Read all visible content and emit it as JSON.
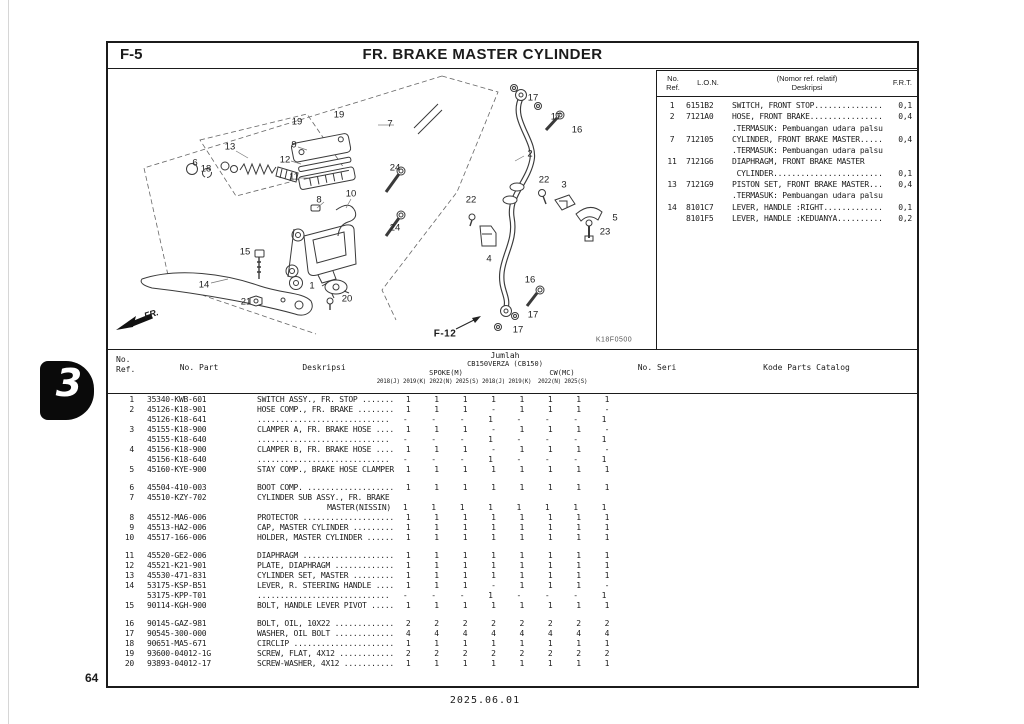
{
  "page": {
    "fig_code": "F-5",
    "title": "FR. BRAKE MASTER CYLINDER",
    "section_tab": "3",
    "page_number": "64",
    "footer_date": "2025.06.01"
  },
  "diagram": {
    "code": "K18F0500",
    "link_label": "F-12",
    "fr_label": "FR.",
    "callouts": [
      {
        "n": "19",
        "x": 189,
        "y": 54
      },
      {
        "n": "19",
        "x": 231,
        "y": 47
      },
      {
        "n": "9",
        "x": 186,
        "y": 77
      },
      {
        "n": "12",
        "x": 177,
        "y": 92
      },
      {
        "n": "11",
        "x": 186,
        "y": 109
      },
      {
        "n": "13",
        "x": 122,
        "y": 79
      },
      {
        "n": "6",
        "x": 87,
        "y": 95
      },
      {
        "n": "18",
        "x": 98,
        "y": 101
      },
      {
        "n": "8",
        "x": 211,
        "y": 132
      },
      {
        "n": "10",
        "x": 243,
        "y": 126
      },
      {
        "n": "15",
        "x": 137,
        "y": 184
      },
      {
        "n": "14",
        "x": 96,
        "y": 217
      },
      {
        "n": "1",
        "x": 204,
        "y": 218
      },
      {
        "n": "21",
        "x": 138,
        "y": 234
      },
      {
        "n": "20",
        "x": 239,
        "y": 231
      },
      {
        "n": "7",
        "x": 282,
        "y": 56
      },
      {
        "n": "24",
        "x": 287,
        "y": 100
      },
      {
        "n": "24",
        "x": 287,
        "y": 160
      },
      {
        "n": "17",
        "x": 425,
        "y": 30
      },
      {
        "n": "17",
        "x": 448,
        "y": 49
      },
      {
        "n": "16",
        "x": 469,
        "y": 62
      },
      {
        "n": "2",
        "x": 422,
        "y": 86
      },
      {
        "n": "22",
        "x": 436,
        "y": 112
      },
      {
        "n": "3",
        "x": 456,
        "y": 117
      },
      {
        "n": "22",
        "x": 363,
        "y": 132
      },
      {
        "n": "5",
        "x": 507,
        "y": 150
      },
      {
        "n": "23",
        "x": 497,
        "y": 164
      },
      {
        "n": "4",
        "x": 381,
        "y": 191
      },
      {
        "n": "16",
        "x": 422,
        "y": 212
      },
      {
        "n": "17",
        "x": 425,
        "y": 247
      },
      {
        "n": "17",
        "x": 410,
        "y": 262
      }
    ]
  },
  "ref_table": {
    "headers": {
      "no_ref_line1": "No.",
      "no_ref_line2": "Ref.",
      "lon": "L.O.N.",
      "desc_line1": "(Nomor ref. relatif)",
      "desc_line2": "Deskripsi",
      "frt": "F.R.T."
    },
    "rows": [
      {
        "ref": "1",
        "lon": "6151B2",
        "desc": "SWITCH, FRONT STOP...............",
        "frt": "0,1"
      },
      {
        "ref": "2",
        "lon": "7121A0",
        "desc": "HOSE, FRONT BRAKE................",
        "frt": "0,4"
      },
      {
        "ref": "",
        "lon": "",
        "desc": ".TERMASUK: Pembuangan udara palsu",
        "frt": ""
      },
      {
        "ref": "7",
        "lon": "712105",
        "desc": "CYLINDER, FRONT BRAKE MASTER.....",
        "frt": "0,4"
      },
      {
        "ref": "",
        "lon": "",
        "desc": ".TERMASUK: Pembuangan udara palsu",
        "frt": ""
      },
      {
        "ref": "11",
        "lon": "7121G6",
        "desc": "DIAPHRAGM, FRONT BRAKE MASTER",
        "frt": ""
      },
      {
        "ref": "",
        "lon": "",
        "desc": " CYLINDER........................",
        "frt": "0,1"
      },
      {
        "ref": "13",
        "lon": "7121G9",
        "desc": "PISTON SET, FRONT BRAKE MASTER...",
        "frt": "0,4"
      },
      {
        "ref": "",
        "lon": "",
        "desc": ".TERMASUK: Pembuangan udara palsu",
        "frt": ""
      },
      {
        "ref": "14",
        "lon": "8101C7",
        "desc": "LEVER, HANDLE :RIGHT.............",
        "frt": "0,1"
      },
      {
        "ref": "",
        "lon": "8101F5",
        "desc": "LEVER, HANDLE :KEDUANYA..........",
        "frt": "0,2"
      }
    ]
  },
  "parts_table": {
    "headers": {
      "no_ref_line1": "No.",
      "no_ref_line2": "Ref.",
      "no_part": "No. Part",
      "deskripsi": "Deskripsi",
      "jumlah": "Jumlah",
      "model": "CB150VERZA (CB150)",
      "spoke": "SPOKE(M)",
      "cw": "CW(MC)",
      "years": "2018(J) 2019(K) 2022(N) 2025(S) 2018(J) 2019(K)  2022(N) 2025(S)",
      "no_seri": "No. Seri",
      "kode": "Kode Parts Catalog"
    },
    "groups": [
      [
        {
          "ref": "1",
          "part": "35340-KWB-601",
          "desc": "SWITCH ASSY., FR. STOP .......",
          "qty": [
            "1",
            "1",
            "1",
            "1",
            "1",
            "1",
            "1",
            "1"
          ]
        },
        {
          "ref": "2",
          "part": "45126-K18-901",
          "desc": "HOSE COMP., FR. BRAKE ........",
          "qty": [
            "1",
            "1",
            "1",
            "-",
            "1",
            "1",
            "1",
            "-"
          ]
        },
        {
          "ref": "",
          "part": "45126-K18-641",
          "desc": ".............................",
          "qty": [
            "-",
            "-",
            "-",
            "1",
            "-",
            "-",
            "-",
            "1"
          ]
        },
        {
          "ref": "3",
          "part": "45155-K18-900",
          "desc": "CLAMPER A, FR. BRAKE HOSE ....",
          "qty": [
            "1",
            "1",
            "1",
            "-",
            "1",
            "1",
            "1",
            "-"
          ]
        },
        {
          "ref": "",
          "part": "45155-K18-640",
          "desc": ".............................",
          "qty": [
            "-",
            "-",
            "-",
            "1",
            "-",
            "-",
            "-",
            "1"
          ]
        },
        {
          "ref": "4",
          "part": "45156-K18-900",
          "desc": "CLAMPER B, FR. BRAKE HOSE ....",
          "qty": [
            "1",
            "1",
            "1",
            "-",
            "1",
            "1",
            "1",
            "-"
          ]
        },
        {
          "ref": "",
          "part": "45156-K18-640",
          "desc": ".............................",
          "qty": [
            "-",
            "-",
            "-",
            "1",
            "-",
            "-",
            "-",
            "1"
          ]
        },
        {
          "ref": "5",
          "part": "45160-KYE-900",
          "desc": "STAY COMP., BRAKE HOSE CLAMPER",
          "qty": [
            "1",
            "1",
            "1",
            "1",
            "1",
            "1",
            "1",
            "1"
          ]
        }
      ],
      [
        {
          "ref": "6",
          "part": "45504-410-003",
          "desc": "BOOT COMP. ...................",
          "qty": [
            "1",
            "1",
            "1",
            "1",
            "1",
            "1",
            "1",
            "1"
          ]
        },
        {
          "ref": "7",
          "part": "45510-KZY-702",
          "desc": "CYLINDER SUB ASSY., FR. BRAKE",
          "qty": [
            "",
            "",
            "",
            "",
            "",
            "",
            "",
            ""
          ]
        },
        {
          "ref": "",
          "part": "",
          "desc": "MASTER(NISSIN)",
          "desc_align": "right",
          "qty": [
            "1",
            "1",
            "1",
            "1",
            "1",
            "1",
            "1",
            "1"
          ]
        },
        {
          "ref": "8",
          "part": "45512-MA6-006",
          "desc": "PROTECTOR ....................",
          "qty": [
            "1",
            "1",
            "1",
            "1",
            "1",
            "1",
            "1",
            "1"
          ]
        },
        {
          "ref": "9",
          "part": "45513-HA2-006",
          "desc": "CAP, MASTER CYLINDER .........",
          "qty": [
            "1",
            "1",
            "1",
            "1",
            "1",
            "1",
            "1",
            "1"
          ]
        },
        {
          "ref": "10",
          "part": "45517-166-006",
          "desc": "HOLDER, MASTER CYLINDER ......",
          "qty": [
            "1",
            "1",
            "1",
            "1",
            "1",
            "1",
            "1",
            "1"
          ]
        }
      ],
      [
        {
          "ref": "11",
          "part": "45520-GE2-006",
          "desc": "DIAPHRAGM ....................",
          "qty": [
            "1",
            "1",
            "1",
            "1",
            "1",
            "1",
            "1",
            "1"
          ]
        },
        {
          "ref": "12",
          "part": "45521-K21-901",
          "desc": "PLATE, DIAPHRAGM .............",
          "qty": [
            "1",
            "1",
            "1",
            "1",
            "1",
            "1",
            "1",
            "1"
          ]
        },
        {
          "ref": "13",
          "part": "45530-471-831",
          "desc": "CYLINDER SET, MASTER .........",
          "qty": [
            "1",
            "1",
            "1",
            "1",
            "1",
            "1",
            "1",
            "1"
          ]
        },
        {
          "ref": "14",
          "part": "53175-KSP-B51",
          "desc": "LEVER, R. STEERING HANDLE ....",
          "qty": [
            "1",
            "1",
            "1",
            "-",
            "1",
            "1",
            "1",
            "-"
          ]
        },
        {
          "ref": "",
          "part": "53175-KPP-T01",
          "desc": ".............................",
          "qty": [
            "-",
            "-",
            "-",
            "1",
            "-",
            "-",
            "-",
            "1"
          ]
        },
        {
          "ref": "15",
          "part": "90114-KGH-900",
          "desc": "BOLT, HANDLE LEVER PIVOT .....",
          "qty": [
            "1",
            "1",
            "1",
            "1",
            "1",
            "1",
            "1",
            "1"
          ]
        }
      ],
      [
        {
          "ref": "16",
          "part": "90145-GAZ-981",
          "desc": "BOLT, OIL, 10X22 .............",
          "qty": [
            "2",
            "2",
            "2",
            "2",
            "2",
            "2",
            "2",
            "2"
          ]
        },
        {
          "ref": "17",
          "part": "90545-300-000",
          "desc": "WASHER, OIL BOLT .............",
          "qty": [
            "4",
            "4",
            "4",
            "4",
            "4",
            "4",
            "4",
            "4"
          ]
        },
        {
          "ref": "18",
          "part": "90651-MA5-671",
          "desc": "CIRCLIP ......................",
          "qty": [
            "1",
            "1",
            "1",
            "1",
            "1",
            "1",
            "1",
            "1"
          ]
        },
        {
          "ref": "19",
          "part": "93600-04012-1G",
          "desc": "SCREW, FLAT, 4X12 ............",
          "qty": [
            "2",
            "2",
            "2",
            "2",
            "2",
            "2",
            "2",
            "2"
          ]
        },
        {
          "ref": "20",
          "part": "93893-04012-17",
          "desc": "SCREW-WASHER, 4X12 ...........",
          "qty": [
            "1",
            "1",
            "1",
            "1",
            "1",
            "1",
            "1",
            "1"
          ]
        }
      ]
    ]
  }
}
